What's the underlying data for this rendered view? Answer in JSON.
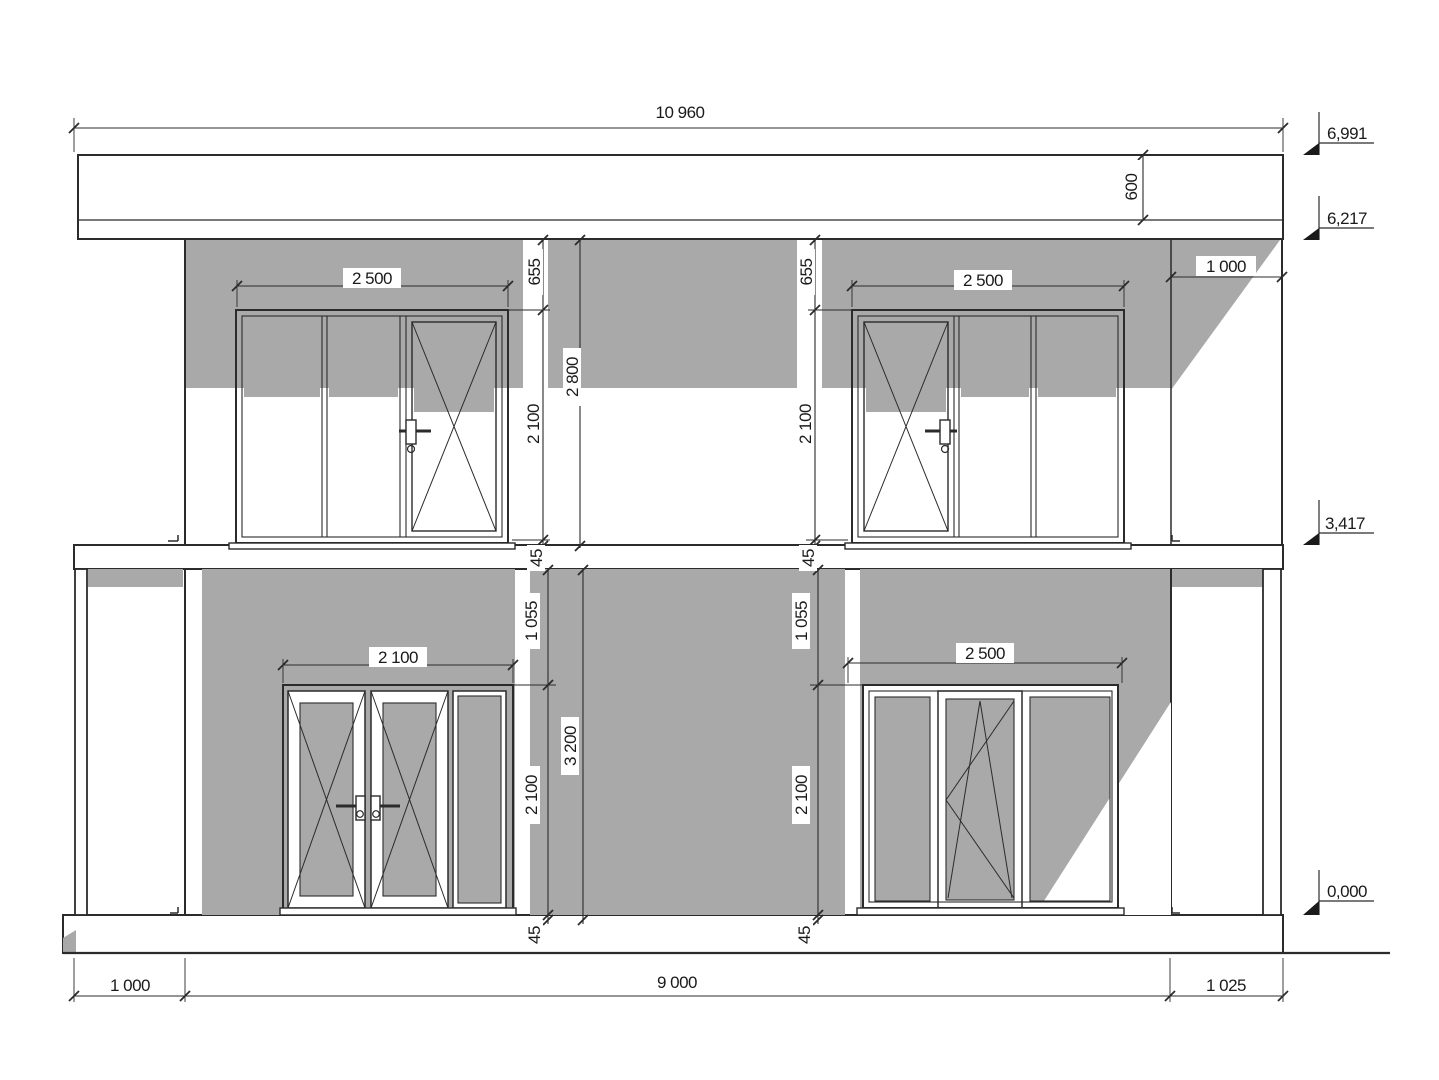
{
  "colors": {
    "shadow_gray": "#a9a9a9",
    "line": "#2b2b2b",
    "text": "#1a1a1a",
    "background": "#ffffff"
  },
  "dims": {
    "top_total": "10 960",
    "fascia_height": "600",
    "recess_width": "1 000",
    "u_left_window_w": "2 500",
    "u_right_window_w": "2 500",
    "u_left_top_offset": "655",
    "u_right_top_offset": "655",
    "u_left_window_h": "2 100",
    "u_right_window_h": "2 100",
    "u_left_gap": "45",
    "u_right_gap": "45",
    "u_floor_h": "2 800",
    "l_door_w": "2 100",
    "l_window_w": "2 500",
    "l_left_top_offset": "1 055",
    "l_right_top_offset": "1 055",
    "l_door_h": "2 100",
    "l_window_h": "2 100",
    "l_left_gap": "45",
    "l_right_gap": "45",
    "l_floor_h": "3 200",
    "b_left": "1 000",
    "b_center": "9 000",
    "b_right": "1 025"
  },
  "levels": {
    "roof_top": "6,991",
    "wall_top": "6,217",
    "floor2": "3,417",
    "ground": "0,000"
  }
}
